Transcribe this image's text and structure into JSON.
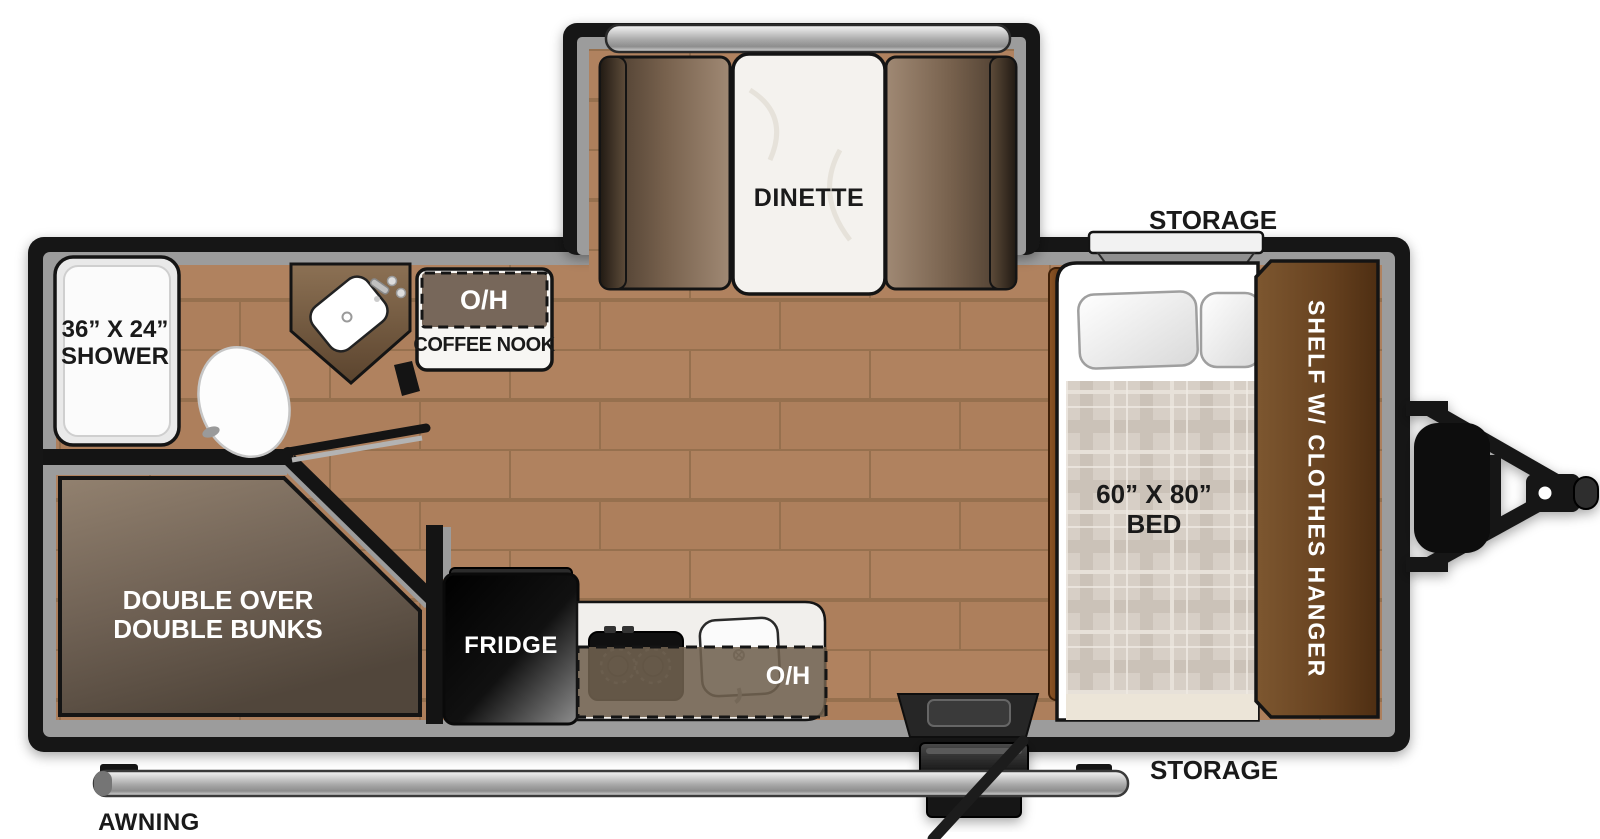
{
  "floorplan": {
    "type": "travel-trailer-floorplan",
    "labels": {
      "dinette": "DINETTE",
      "storage_front": "STORAGE",
      "storage_rear": "STORAGE",
      "shower_line1": "36” X 24”",
      "shower_line2": "SHOWER",
      "coffee_overhead": "O/H",
      "coffee_nook": "COFFEE NOOK",
      "kitchen_overhead": "O/H",
      "fridge": "FRIDGE",
      "bunks_line1": "DOUBLE OVER",
      "bunks_line2": "DOUBLE BUNKS",
      "bed_line1": "60” X 80”",
      "bed_line2": "BED",
      "shelf": "SHELF W/ CLOTHES HANGER",
      "awning": "AWNING"
    },
    "colors": {
      "wall": "#141414",
      "trim": "#9c9c9c",
      "floor_wood": "#b0825f",
      "cabinet_brown": "#6e4a28",
      "bunk_brown": "#6f6154",
      "counter_white": "#f1efec",
      "metal_silver": "#c9c9c9",
      "label_dark": "#1a1a1a",
      "label_light": "#ffffff"
    }
  }
}
